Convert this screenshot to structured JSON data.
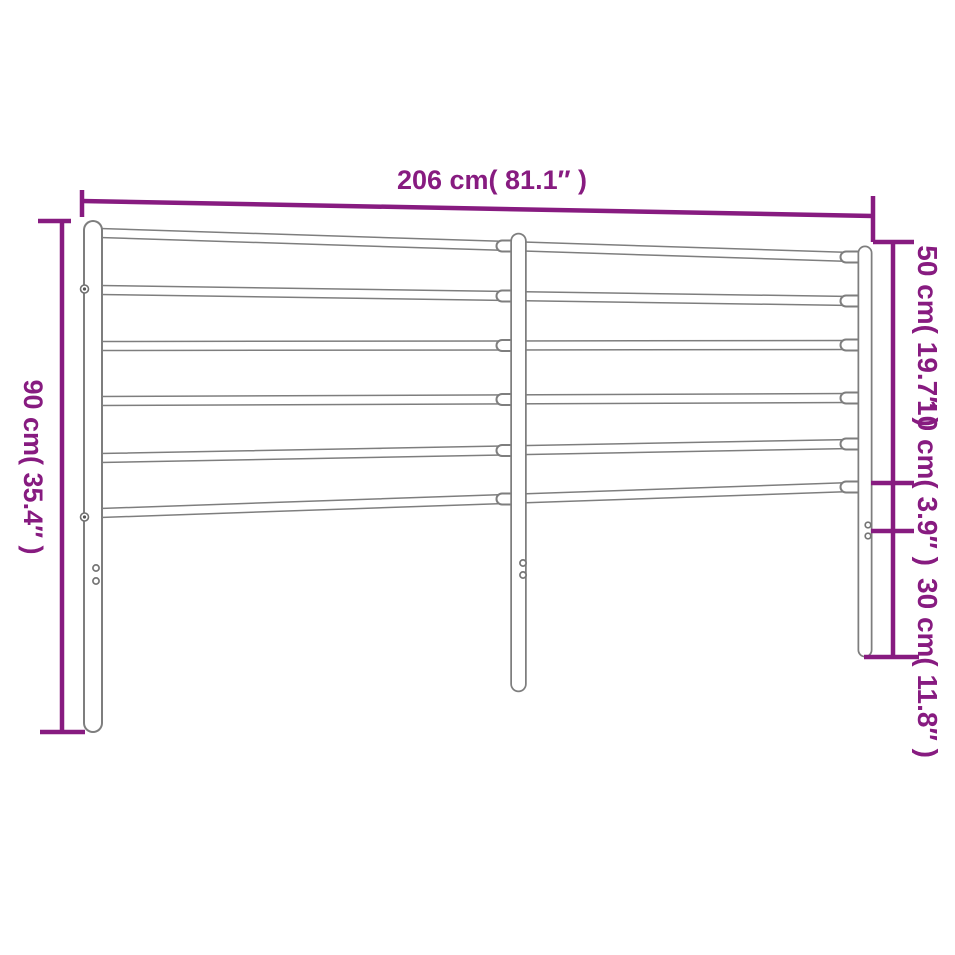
{
  "page": {
    "background": "#ffffff"
  },
  "diagram": {
    "name": "metal headboard dimension drawing",
    "colors": {
      "dimension_accent": "#871b80",
      "drawing_outline": "#7e7e7e",
      "background": "#ffffff"
    },
    "measurements": {
      "width": {
        "cm": 206,
        "inches": 81.1,
        "label": "206 cm( 81.1″ )"
      },
      "height": {
        "cm": 90,
        "inches": 35.4,
        "label": "90 cm( 35.4″ )"
      },
      "upper_section": {
        "cm": 50,
        "inches": 19.7,
        "label": "50 cm( 19.7″ )"
      },
      "middle_section": {
        "cm": 10,
        "inches": 3.9,
        "label": "10 cm( 3.9″ )"
      },
      "lower_section": {
        "cm": 30,
        "inches": 11.8,
        "label": "30 cm( 11.8″ )"
      }
    },
    "structure": {
      "posts": 3,
      "horizontal_rails": 6
    }
  }
}
